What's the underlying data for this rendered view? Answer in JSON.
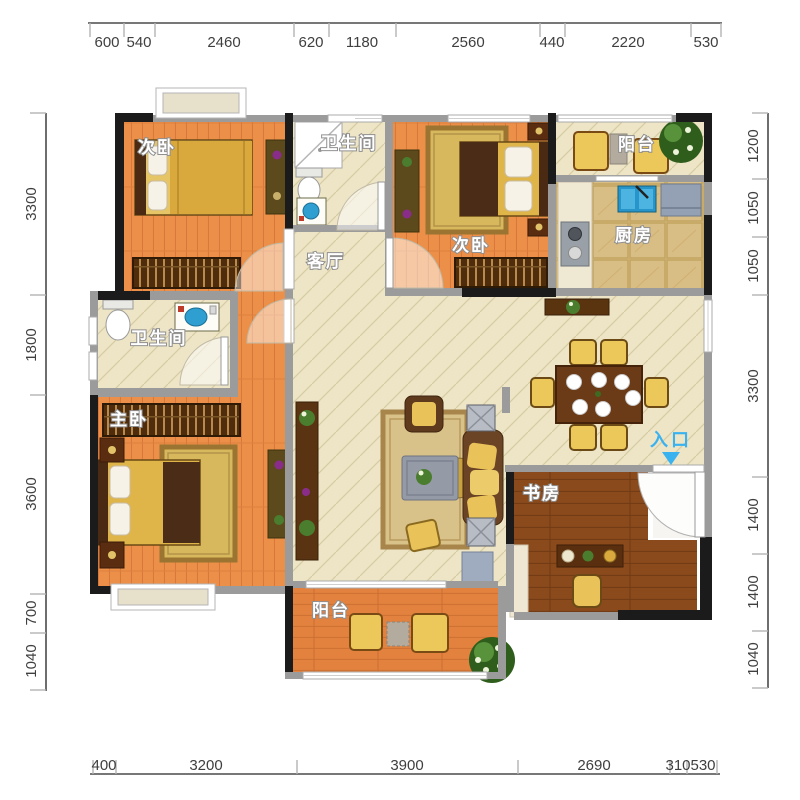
{
  "rooms": {
    "bedroom1": "次卧",
    "bathroom1": "卫生间",
    "bedroom2": "次卧",
    "balcony1": "阳台",
    "kitchen": "厨房",
    "living": "客厅",
    "bathroom2": "卫生间",
    "master": "主卧",
    "study": "书房",
    "balcony2": "阳台",
    "entrance": "入口"
  },
  "dims": {
    "top": [
      "600",
      "540",
      "2460",
      "620",
      "1180",
      "2560",
      "440",
      "2220",
      "530"
    ],
    "bottom": [
      "400",
      "3200",
      "3900",
      "2690",
      "310",
      "530"
    ],
    "left": [
      "3300",
      "1800",
      "3600",
      "700",
      "1040"
    ],
    "right": [
      "1200",
      "1050",
      "1050",
      "3300",
      "1400",
      "1400",
      "1040"
    ]
  },
  "colors": {
    "entrance_accent": "#3ab2f0",
    "wall_gray": "#9b9b9b",
    "wall_black": "#1b1b1b",
    "wood_floor": "#ec9049",
    "living_floor": "#ede5c6",
    "kitchen_floor": "#d8bd85",
    "study_floor": "#8a4a1c",
    "dimension_text": "#3f3f3f"
  }
}
